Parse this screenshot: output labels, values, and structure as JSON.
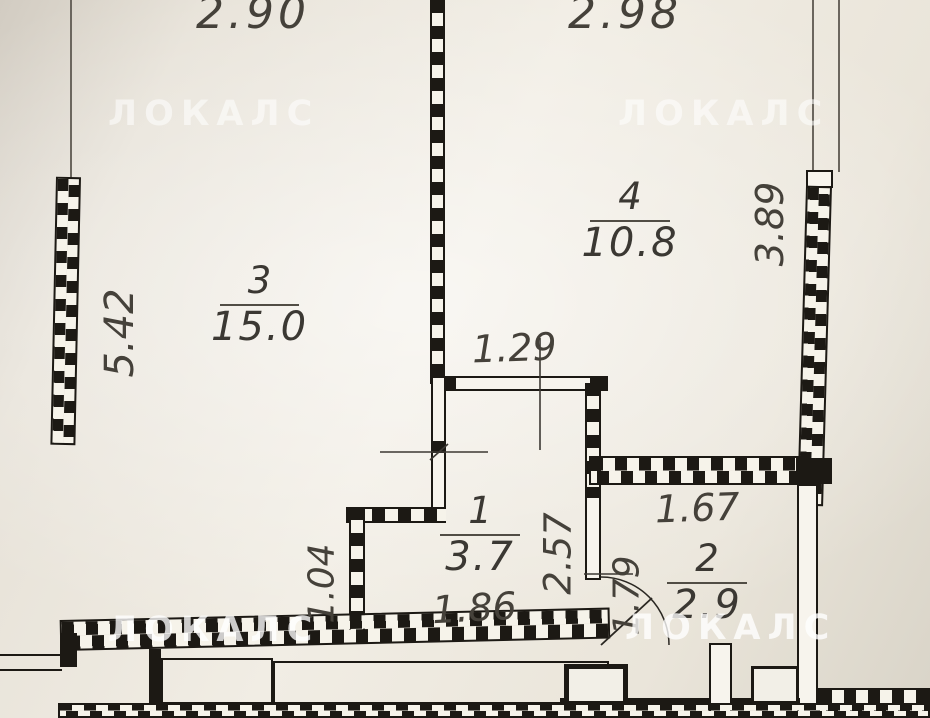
{
  "watermark": {
    "text": "ЛОКАЛС"
  },
  "rooms": [
    {
      "number": "3",
      "area": "15.0"
    },
    {
      "number": "4",
      "area": "10.8"
    },
    {
      "number": "1",
      "area": "3.7"
    },
    {
      "number": "2",
      "area": "2.9"
    }
  ],
  "dimensions": {
    "top_left": "2.90",
    "top_right": "2.98",
    "left_wall": "5.42",
    "right_wall": "3.89",
    "hall_top_width": "1.29",
    "hall_width": "1.86",
    "hall_depth": "2.57",
    "room2_left_depth": "1.79",
    "room2_width": "1.67",
    "hall_lower_left": "1.04"
  },
  "colors": {
    "ink": "#1c1914",
    "paper": "#f1ede4",
    "dimension_text": "#45413a",
    "watermark": "#ffffff"
  }
}
